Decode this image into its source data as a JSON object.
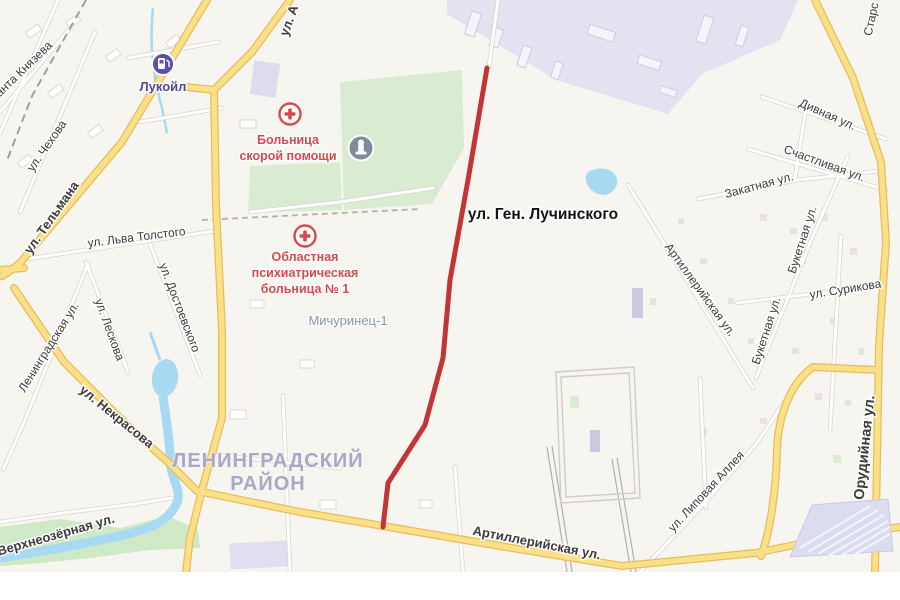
{
  "map": {
    "district": {
      "line1": "ЛЕНИНГРАДСКИЙ",
      "line2": "РАЙОН"
    },
    "neighborhood": {
      "name": "Мичуринец-1"
    },
    "highlight": {
      "street": "ул. Ген. Лучинского",
      "color": "#c23537"
    },
    "pois": [
      {
        "name": "Лукойл",
        "type": "fuel-station"
      },
      {
        "line1": "Больница",
        "line2": "скорой помощи",
        "type": "hospital"
      },
      {
        "line1": "Областная",
        "line2": "психиатрическая",
        "line3": "больница № 1",
        "type": "hospital"
      },
      {
        "type": "monument"
      }
    ],
    "streets": [
      {
        "name": "ул. А"
      },
      {
        "name": "нанта Князева"
      },
      {
        "name": "ул. Чехова"
      },
      {
        "name": "ул. Тельмана"
      },
      {
        "name": "ул. Льва Толстого"
      },
      {
        "name": "ул. Достоевского"
      },
      {
        "name": "ул. Лескова"
      },
      {
        "name": "Ленинградская ул."
      },
      {
        "name": "ул. Некрасова"
      },
      {
        "name": "Верхнеозёрная ул."
      },
      {
        "name": "Артиллерийская ул."
      },
      {
        "name": "ул. Ген. Лучинского"
      },
      {
        "name": "Артиллерийская ул."
      },
      {
        "name": "ул. Сурикова"
      },
      {
        "name": "Букетная ул."
      },
      {
        "name": "Букетная ул."
      },
      {
        "name": "Дивная ул."
      },
      {
        "name": "Счастливая ул."
      },
      {
        "name": "Закатная ул."
      },
      {
        "name": "ул. Липовая Аллея"
      },
      {
        "name": "Орудийная ул."
      },
      {
        "name": "Старс"
      }
    ],
    "colors": {
      "background": "#f7f5f0",
      "route_highlight": "#c23537",
      "major_road_fill": "#fce088",
      "major_road_casing": "#e5bd5e",
      "minor_road_fill": "#fefefc",
      "minor_road_casing": "#d8d5cd",
      "water": "#a8d9f2",
      "park": "#d9ecd2",
      "industrial_zone": "#e2e2f1",
      "district_label": "#a8a8c8",
      "hospital_poi": "#d6494d",
      "fuel_poi": "#5b50ad",
      "monument_poi": "#7e8c99"
    }
  }
}
